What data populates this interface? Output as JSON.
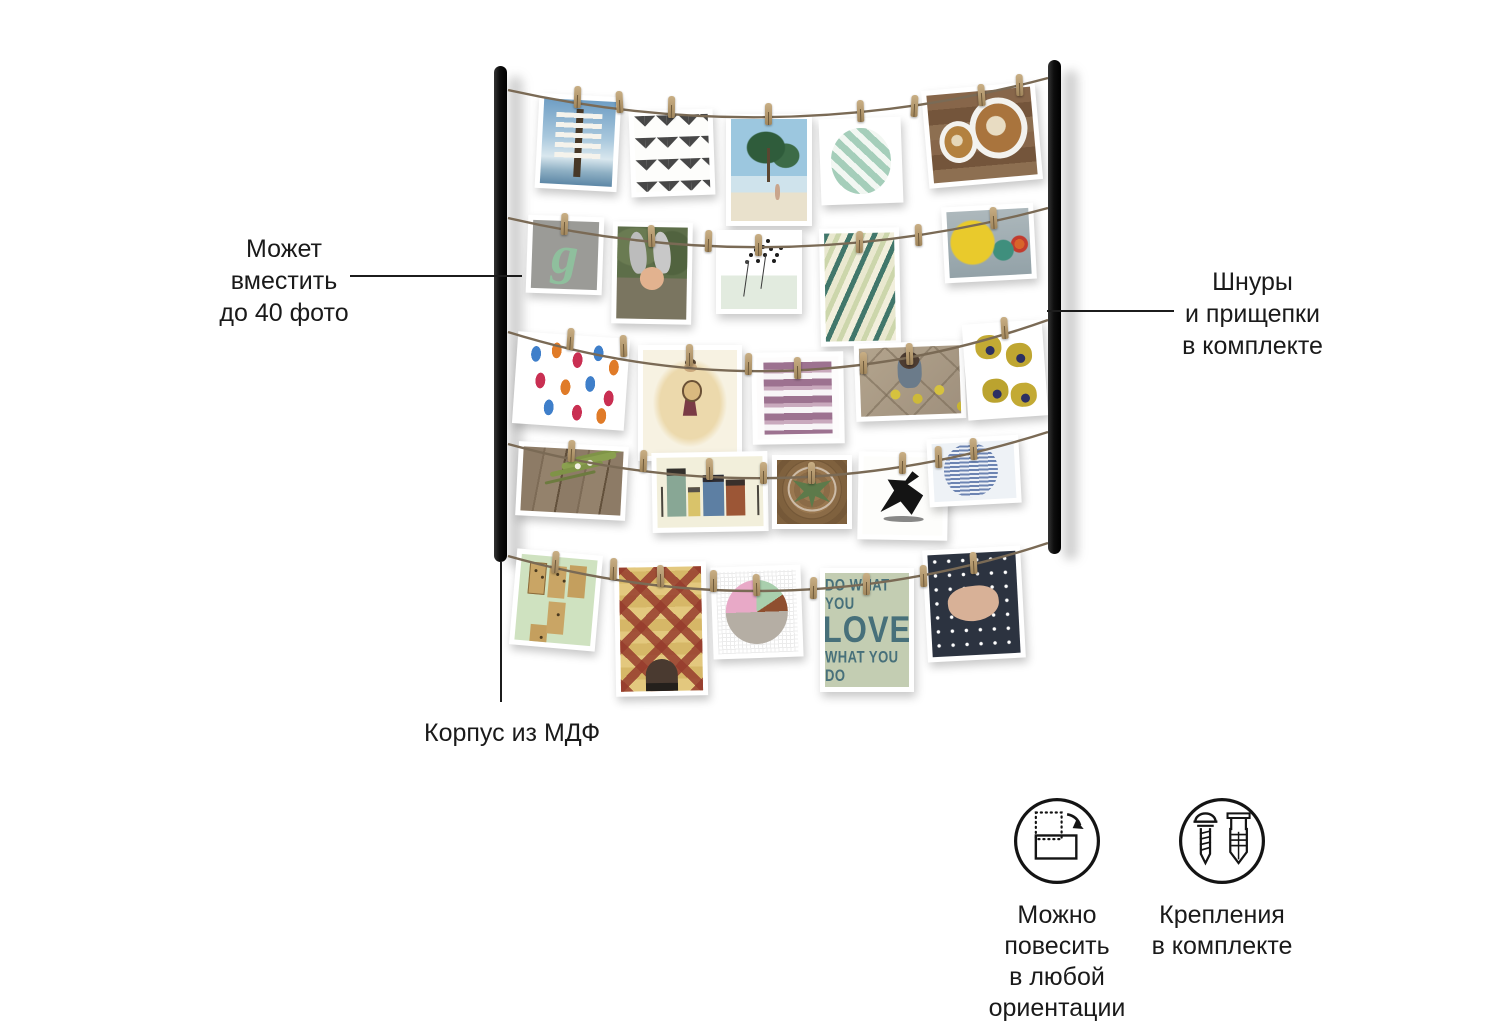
{
  "illustration": {
    "kind": "product-infographic",
    "background_color": "#ffffff",
    "frame": {
      "rail_color": "#141414",
      "wire_color": "#7a6a55",
      "clothespin_color": "#b29469",
      "rail_count": 2,
      "wire_count": 5
    },
    "photos": [
      {
        "id": "signpost-beach",
        "description": "wooden signpost with white direction signs against blue sea and sky"
      },
      {
        "id": "black-zigzag-pattern",
        "description": "black watercolor chevron zigzag strokes on white"
      },
      {
        "id": "palm-beach-walk",
        "description": "palm trees over a beach with a person walking"
      },
      {
        "id": "green-triangle-circle",
        "description": "mint green geometric triangle pattern in a circle"
      },
      {
        "id": "latte-art-coffee",
        "description": "two latte art coffee cups on a wooden table"
      },
      {
        "id": "letter-g-card",
        "description": "grey card with a green script letter g"
      },
      {
        "id": "bunny-ears-child",
        "description": "child wearing grey bunny ears in greenery"
      },
      {
        "id": "dandelion-illustration",
        "description": "ink dandelion seed heads on white and mint"
      },
      {
        "id": "fish-pattern",
        "description": "diagonal teal and cream fish pattern"
      },
      {
        "id": "color-circles-card",
        "description": "yellow, teal and orange circles on grey-blue"
      },
      {
        "id": "popsicle-pattern",
        "description": "blue, orange and crimson popsicles on white"
      },
      {
        "id": "banjo-girl-illustration",
        "description": "girl playing a banjo on cream background"
      },
      {
        "id": "mauve-brush-stripes",
        "description": "mauve watercolor horizontal brush stripes"
      },
      {
        "id": "toddler-with-lemons",
        "description": "toddler on tiled floor playing with lemons"
      },
      {
        "id": "yellow-flowers",
        "description": "mustard yellow flowers with navy centers on white"
      },
      {
        "id": "sprig-on-wood",
        "description": "green plant sprig lying on wooden planks"
      },
      {
        "id": "houses-illustration",
        "description": "row of colorful town houses with street lamps on cream"
      },
      {
        "id": "succulent-top-view",
        "description": "succulent in a glass on a wooden stump, top view"
      },
      {
        "id": "ink-figure",
        "description": "black ink silhouette of a dancing figure on white"
      },
      {
        "id": "blue-circle-text",
        "description": "steel blue circle filled with tiny handwriting on pale blue"
      },
      {
        "id": "dominoes-card",
        "description": "wooden dominoes on a mint green card"
      },
      {
        "id": "quilt-pattern",
        "description": "folk quilt diamond pattern in red and tan"
      },
      {
        "id": "pie-circle-collage",
        "description": "circle of pink, green, brown and marble quarters on hatched white"
      },
      {
        "id": "do-what-you-love-card",
        "description": "sage green typography card"
      },
      {
        "id": "hands-polka-dots",
        "description": "folded hands over navy polka dot fabric"
      }
    ],
    "texts": {
      "letter_card": "g",
      "quote_lines": [
        "DO WHAT YOU",
        "LOVE",
        "WHAT YOU DO"
      ]
    }
  },
  "annotations": {
    "capacity": {
      "lines": [
        "Может",
        "вместить",
        "до 40 фото"
      ]
    },
    "cords": {
      "lines": [
        "Шнуры",
        "и прищепки",
        "в комплекте"
      ]
    },
    "material": {
      "text": "Корпус из МДФ"
    }
  },
  "features": [
    {
      "icon": "rotate-orientation-icon",
      "lines": [
        "Можно повесить",
        "в любой",
        "ориентации"
      ]
    },
    {
      "icon": "screw-and-anchor-icon",
      "lines": [
        "Крепления",
        "в комплекте"
      ]
    }
  ]
}
